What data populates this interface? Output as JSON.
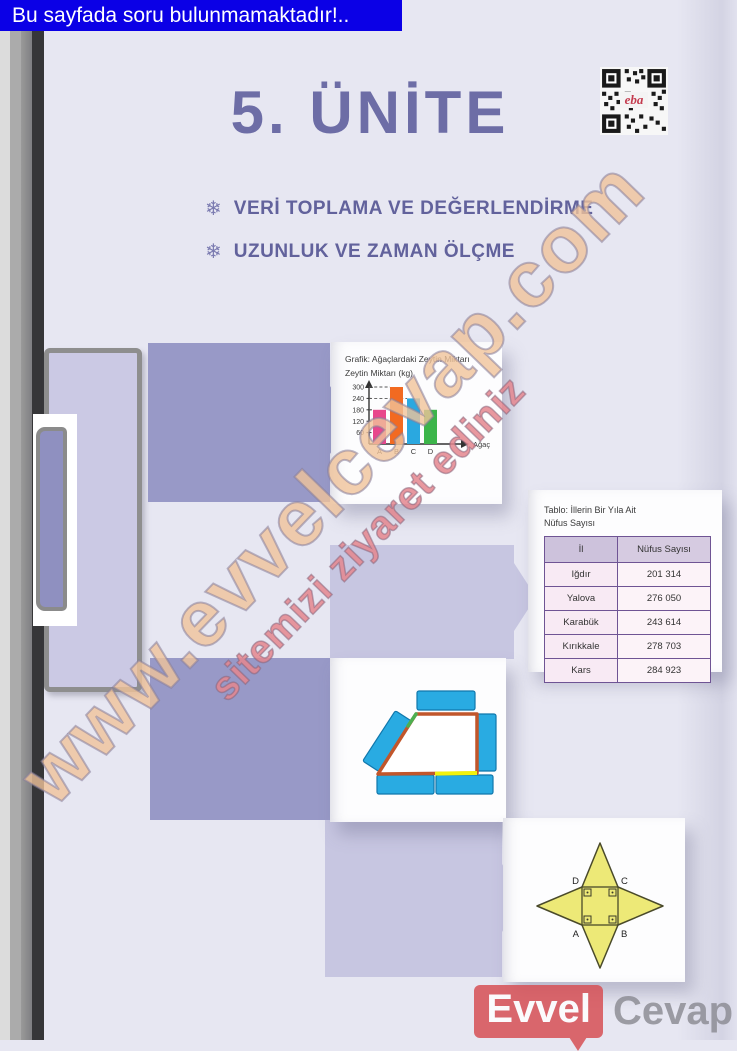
{
  "page": {
    "notice": "Bu sayfada soru bulunmamaktadır!..",
    "notice_bg": "#0b00e6",
    "background": "#e7e7f2"
  },
  "unit": {
    "title": "5. ÜNİTE",
    "title_color": "#6d6da6",
    "bullet_glyph": "❄",
    "topics": [
      "VERİ TOPLAMA VE DEĞERLENDİRME",
      "UZUNLUK VE ZAMAN ÖLÇME"
    ]
  },
  "qr": {
    "label": "eba",
    "label_color": "#c43b4e"
  },
  "chart_data": {
    "type": "bar",
    "title": "Grafik: Ağaçlardaki Zeytin Miktarı",
    "ylabel": "Zeytin Miktarı (kg)",
    "xlabel": "Ağaç",
    "categories": [
      "A",
      "B",
      "C",
      "D"
    ],
    "values": [
      180,
      300,
      240,
      180
    ],
    "bar_colors": [
      "#e8468c",
      "#f26a21",
      "#2aa8e0",
      "#3cb54a"
    ],
    "yticks": [
      60,
      120,
      180,
      240,
      300
    ],
    "ylim": [
      0,
      330
    ],
    "grid": "dashed guide lines from y-axis to bar tops",
    "legend": "none"
  },
  "table_data": {
    "type": "table",
    "title": "Tablo: İllerin Bir Yıla Ait Nüfus Sayısı",
    "title_lines": [
      "Tablo: İllerin Bir Yıla Ait",
      "Nüfus Sayısı"
    ],
    "columns": [
      "İl",
      "Nüfus Sayısı"
    ],
    "rows": [
      [
        "Iğdır",
        "201 314"
      ],
      [
        "Yalova",
        "276 050"
      ],
      [
        "Karabük",
        "243 614"
      ],
      [
        "Kırıkkale",
        "278 703"
      ],
      [
        "Kars",
        "284 923"
      ]
    ]
  },
  "shapes": {
    "trapezoid": {
      "description": "trapezoid outlined in orange with one green and one yellow edge segment, surrounded by blue rectangular blocks",
      "block_color": "#29abe2",
      "outline_colors": [
        "#c1562b",
        "#4caf50",
        "#f2f20c"
      ]
    },
    "star": {
      "description": "four-pointed yellow star with central square and right-angle marks",
      "fill": "#ede977",
      "labels": {
        "tl": "D",
        "tr": "C",
        "bl": "A",
        "br": "B"
      }
    }
  },
  "watermark": {
    "line1": "www.evvelcevap.com",
    "line2": "sitemizi ziyaret ediniz",
    "line1_color": "#f0c39a",
    "line2_color": "#e4868e"
  },
  "logo": {
    "primary": "Evvel",
    "secondary": "Cevap",
    "badge_color": "#d75055"
  }
}
